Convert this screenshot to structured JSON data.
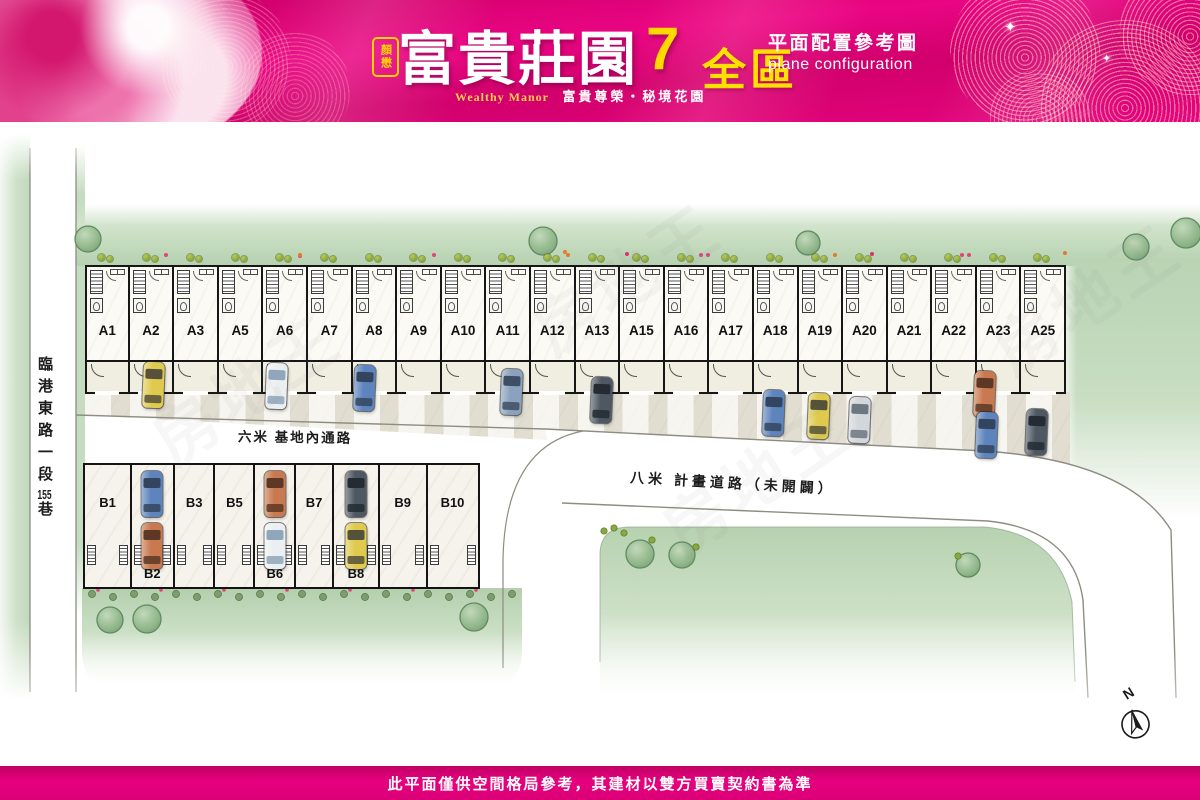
{
  "header": {
    "seal": "顏懋",
    "title": "富貴莊園",
    "number": "7",
    "brand_en": "Wealthy Manor",
    "tagline": "富貴尊榮・秘境花園",
    "zone": "全區",
    "config_zh": "平面配置參考圖",
    "config_en": "plane configuration",
    "colors": {
      "bg": "#e6007f",
      "accent": "#ffd800"
    }
  },
  "roads": {
    "west_pre": "臨港東路一段",
    "west_num": "155",
    "west_suf": "巷",
    "inner": "六米 基地內通路",
    "planned": "八米 計畫道路（未開闢）"
  },
  "footer": {
    "disclaimer": "此平面僅供空間格局參考，其建材以雙方買賣契約書為準"
  },
  "compass": {
    "label": "N"
  },
  "watermark": "房地王",
  "units_a": [
    "A1",
    "A2",
    "A3",
    "A5",
    "A6",
    "A7",
    "A8",
    "A9",
    "A10",
    "A11",
    "A12",
    "A13",
    "A15",
    "A16",
    "A17",
    "A18",
    "A19",
    "A20",
    "A21",
    "A22",
    "A23",
    "A25"
  ],
  "cars_a": [
    {
      "x": 143,
      "y": 362,
      "c": "yellow"
    },
    {
      "x": 266,
      "y": 363,
      "c": "white"
    },
    {
      "x": 354,
      "y": 365,
      "c": "blue"
    },
    {
      "x": 501,
      "y": 369,
      "c": "steel"
    },
    {
      "x": 591,
      "y": 377,
      "c": "dark"
    },
    {
      "x": 763,
      "y": 390,
      "c": "blue"
    },
    {
      "x": 808,
      "y": 393,
      "c": "yellow"
    },
    {
      "x": 849,
      "y": 397,
      "c": "silver"
    },
    {
      "x": 974,
      "y": 371,
      "c": "orange"
    },
    {
      "x": 976,
      "y": 412,
      "c": "blue"
    },
    {
      "x": 1026,
      "y": 409,
      "c": "dark"
    }
  ],
  "units_b": [
    {
      "label": "B1",
      "w": 49,
      "labelPos": "top",
      "cars": []
    },
    {
      "label": "B2",
      "w": 45,
      "labelPos": "bottom",
      "cars": [
        "blue",
        "orange"
      ]
    },
    {
      "label": "B3",
      "w": 43,
      "labelPos": "top",
      "cars": []
    },
    {
      "label": "B5",
      "w": 42,
      "labelPos": "top",
      "cars": []
    },
    {
      "label": "B6",
      "w": 43,
      "labelPos": "bottom",
      "cars": [
        "orange",
        "white"
      ]
    },
    {
      "label": "B7",
      "w": 40,
      "labelPos": "top",
      "cars": []
    },
    {
      "label": "B8",
      "w": 48,
      "labelPos": "bottom",
      "cars": [
        "dark",
        "yellow"
      ]
    },
    {
      "label": "B9",
      "w": 50,
      "labelPos": "top",
      "cars": []
    },
    {
      "label": "B10",
      "w": 54,
      "labelPos": "top",
      "cars": []
    }
  ],
  "car_colors": {
    "yellow": {
      "body": "#dfca4d",
      "glass": "#55513a"
    },
    "white": {
      "body": "#eceff1",
      "glass": "#8fa6bb"
    },
    "blue": {
      "body": "#5d84bd",
      "glass": "#33455e"
    },
    "steel": {
      "body": "#8aa2bd",
      "glass": "#3e4f63"
    },
    "dark": {
      "body": "#4e5862",
      "glass": "#252b33"
    },
    "silver": {
      "body": "#d3d7db",
      "glass": "#6d7780"
    },
    "orange": {
      "body": "#c8794f",
      "glass": "#5c3825"
    }
  },
  "trees": [
    {
      "x": 88,
      "y": 239,
      "r": 13
    },
    {
      "x": 543,
      "y": 241,
      "r": 14
    },
    {
      "x": 808,
      "y": 243,
      "r": 12
    },
    {
      "x": 1136,
      "y": 247,
      "r": 13
    },
    {
      "x": 1186,
      "y": 233,
      "r": 15
    },
    {
      "x": 1227,
      "y": 230,
      "r": 16
    },
    {
      "x": 110,
      "y": 620,
      "r": 13
    },
    {
      "x": 147,
      "y": 619,
      "r": 14
    },
    {
      "x": 474,
      "y": 617,
      "r": 14
    },
    {
      "x": 640,
      "y": 554,
      "r": 14
    },
    {
      "x": 682,
      "y": 555,
      "r": 13
    },
    {
      "x": 968,
      "y": 565,
      "r": 12
    }
  ]
}
